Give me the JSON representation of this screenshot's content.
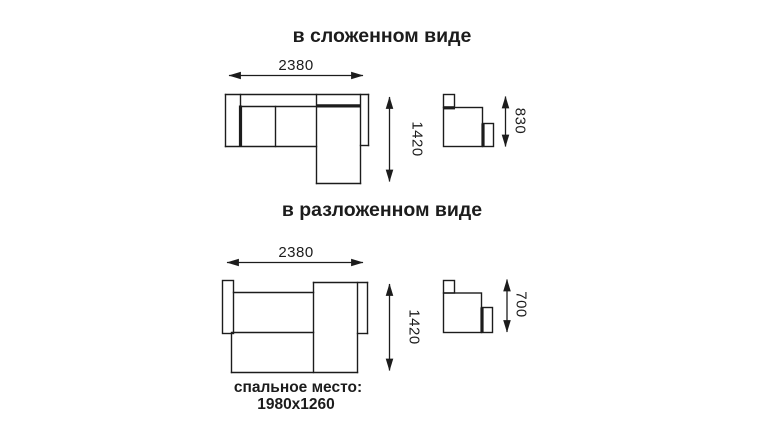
{
  "drawing": {
    "folded": {
      "title": "в сложенном виде",
      "width_mm": "2380",
      "depth_mm": "1420",
      "height_mm": "830"
    },
    "unfolded": {
      "title": "в разложенном виде",
      "width_mm": "2380",
      "depth_mm": "1420",
      "height_mm": "700",
      "sleeping_area_label": "спальное место:",
      "sleeping_area_size": "1980x1260"
    },
    "colors": {
      "line": "#1c1c1c",
      "background": "#ffffff"
    }
  }
}
